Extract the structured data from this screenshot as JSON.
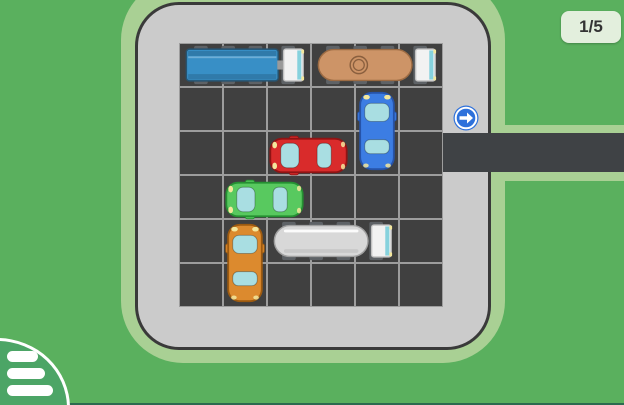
{
  "hud": {
    "level_label": "1/5",
    "exit_sign_icon": "arrow-right-circle"
  },
  "menu": {
    "icon": "hamburger-menu"
  },
  "board": {
    "rows": 6,
    "cols": 6,
    "cell_px": 44,
    "origin_px": {
      "x": 179,
      "y": 43
    },
    "exit": {
      "side": "right",
      "row": 2
    },
    "vehicles": [
      {
        "id": "blue-truck",
        "kind": "truck",
        "color": "#388FC6",
        "outline": "#27536F",
        "row": 0,
        "col": 0,
        "length": 3,
        "orientation": "horizontal",
        "facing": "right"
      },
      {
        "id": "tan-tanker",
        "kind": "tanker",
        "color": "#CD9467",
        "outline": "#9C6B43",
        "detail": "tank-lid",
        "row": 0,
        "col": 3,
        "length": 3,
        "orientation": "horizontal",
        "facing": "right"
      },
      {
        "id": "blue-car",
        "kind": "car",
        "color": "#3C7DE3",
        "outline": "#2653A8",
        "row": 1,
        "col": 4,
        "length": 2,
        "orientation": "vertical",
        "facing": "up"
      },
      {
        "id": "red-car",
        "kind": "car",
        "color": "#D92B2B",
        "outline": "#8F1414",
        "row": 2,
        "col": 2,
        "length": 2,
        "orientation": "horizontal",
        "facing": "left"
      },
      {
        "id": "green-car",
        "kind": "car",
        "color": "#58C95F",
        "outline": "#259032",
        "row": 3,
        "col": 1,
        "length": 2,
        "orientation": "horizontal",
        "facing": "left"
      },
      {
        "id": "orange-car",
        "kind": "car",
        "color": "#DC8A2E",
        "outline": "#9C5A10",
        "row": 4,
        "col": 1,
        "length": 2,
        "orientation": "vertical",
        "facing": "up"
      },
      {
        "id": "white-tanker",
        "kind": "tanker",
        "color": "#D8D8D8",
        "outline": "#A0A0A0",
        "detail": "stripe",
        "row": 4,
        "col": 2,
        "length": 3,
        "orientation": "horizontal",
        "facing": "right"
      }
    ]
  },
  "colors": {
    "background": "#5AB05E",
    "halo": "#A9D094",
    "board": "#CBCBCB",
    "board_border": "#3A3A3A",
    "cell": "#404040",
    "grid_line": "#9D9D9D",
    "road": "#3F4245",
    "badge_bg": "#E3EFDD",
    "badge_text": "#333333",
    "sign_blue": "#2E71DB",
    "menu_green": "#4CA566",
    "bottom_strip": "#2B6B4F",
    "window": "#A9DEE2",
    "headlight": "#F4E79C",
    "cab": "#F2F2F2",
    "cab_strip": "#86D2DD",
    "wheel": "#5E6266"
  }
}
